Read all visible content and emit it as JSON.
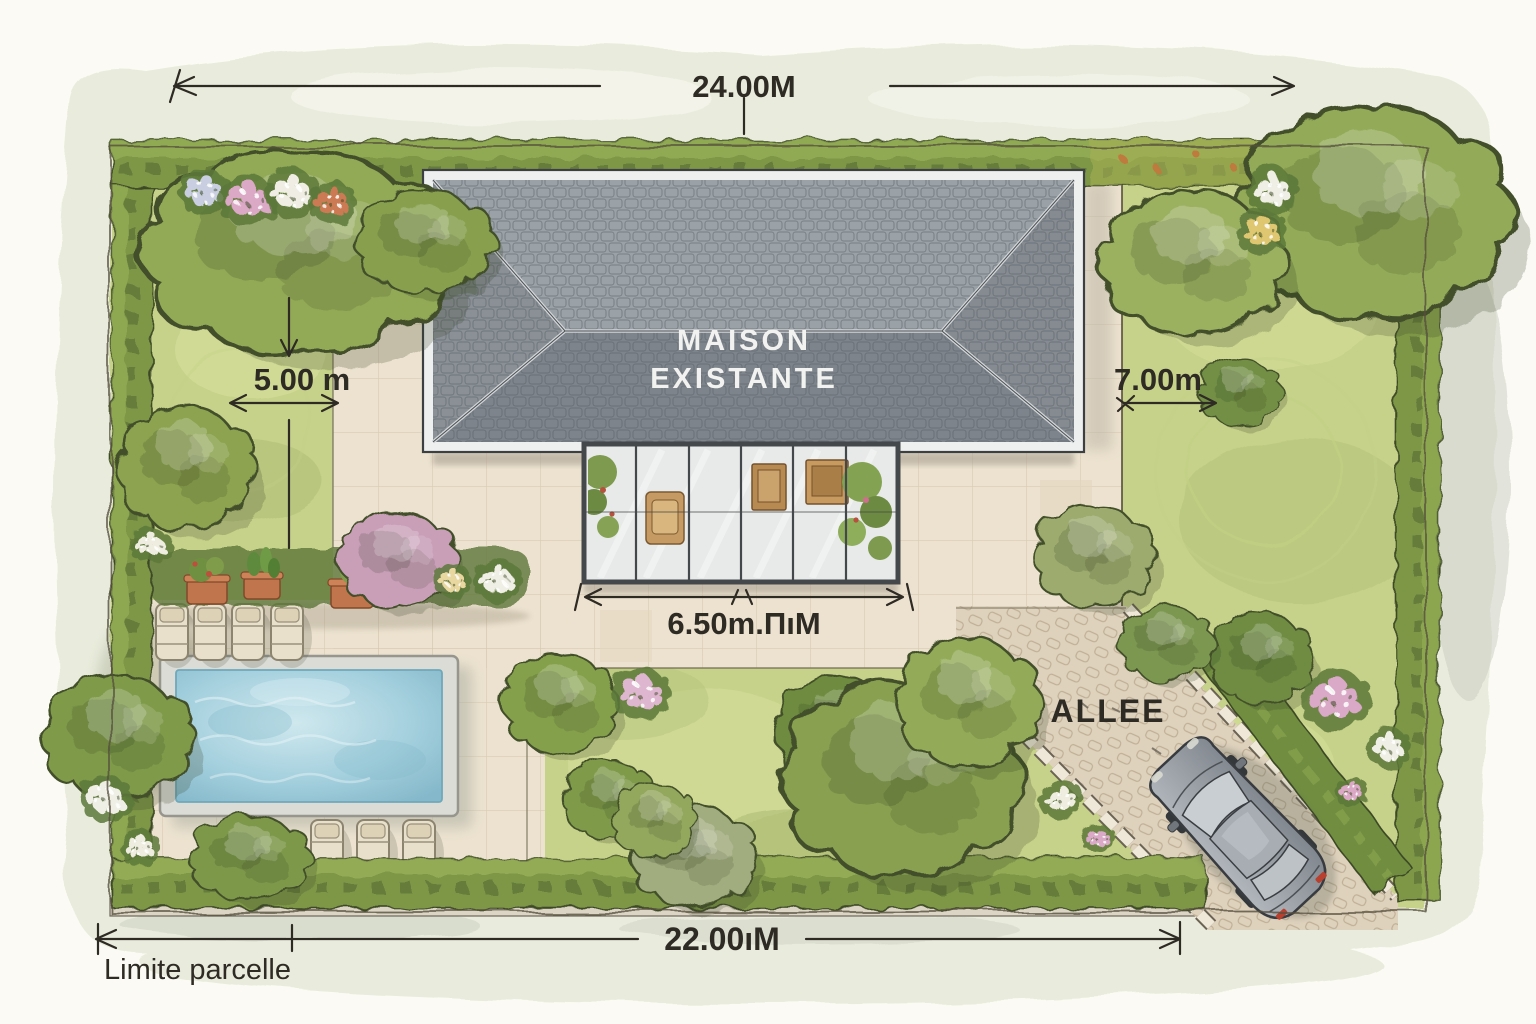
{
  "plan": {
    "house": {
      "label_line1": "MAISON",
      "label_line2": "EXISTANTE"
    },
    "driveway": {
      "label": "ALLEE"
    },
    "dimensions": {
      "width_top": "24.00M",
      "side_left": "5.00 m",
      "side_right": "7.00m",
      "veranda": "6.50m.ΠıM",
      "width_bottom": "22.00ıM"
    },
    "legend": {
      "boundary": "Limite parcelle"
    },
    "palette": {
      "paper": "#fbfaf4",
      "wash": "#e9ecdc",
      "lawn": "#c6d189",
      "hedge": "#7d9746",
      "patio": "#ece2cf",
      "drive": "#ded2bd",
      "roofLight": "#9aa1a7",
      "roofDark": "#7d848b",
      "pool": "#9ccadb",
      "car": "#8f959b",
      "ink": "#2e2a24"
    }
  }
}
